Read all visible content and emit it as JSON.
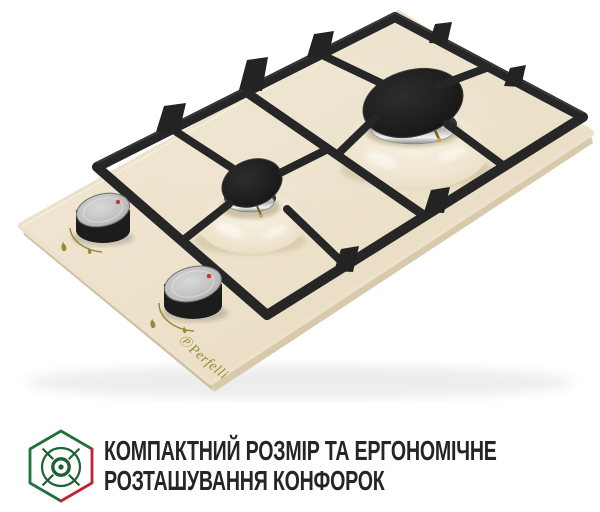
{
  "page": {
    "background": "#ffffff"
  },
  "product": {
    "description": "built-in domino gas hob, two burners, ivory glass, black cast-iron grates, perspective product photo",
    "brand_symbol": "Ⓟ",
    "brand": "Perfelli",
    "colors": {
      "glass": "#ece1ca",
      "glass_edge": "#d8c9aa",
      "grate_black": "#262626",
      "burner_cap": "#181818",
      "chrome": "#c8c8c8",
      "knob_black": "#1c1c1c",
      "knob_silver": "#bfbfbf",
      "indicator_red": "#c43a2c",
      "brand_gold": "#9a8a33"
    }
  },
  "caption": {
    "icon_name": "hexagon-burner-icon",
    "icon_colors": {
      "green": "#20713b",
      "red": "#c22233",
      "glyph": "#1d6234"
    },
    "line1": "КОМПАКТНИЙ РОЗМІР ТА ЕРГОНОМІЧНЕ",
    "line2": "РОЗТАШУВАННЯ КОНФОРОК",
    "text_color": "#272326"
  }
}
